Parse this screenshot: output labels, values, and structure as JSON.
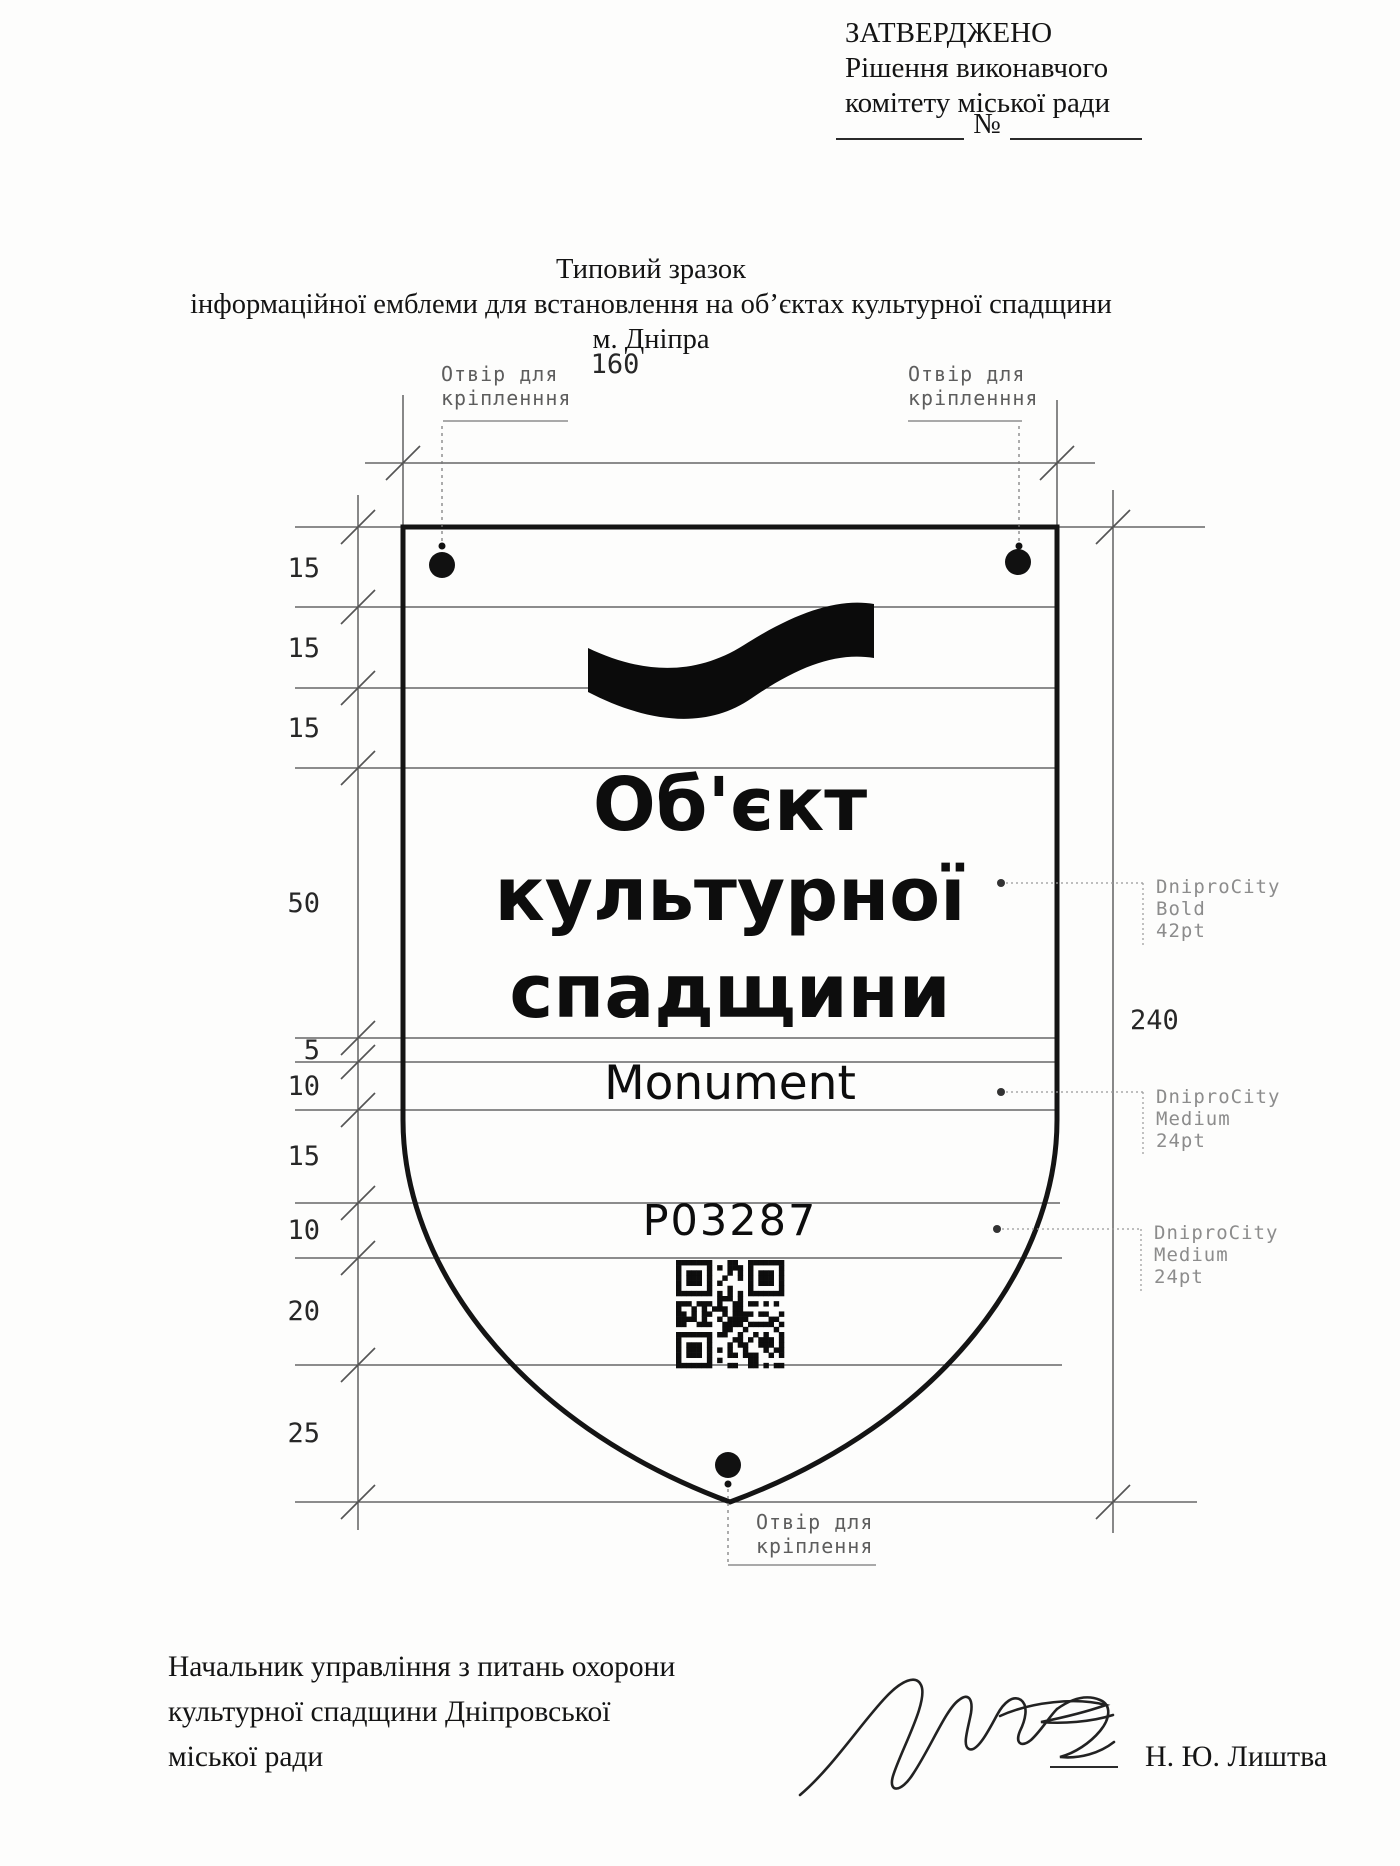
{
  "approval": {
    "line1": "ЗАТВЕРДЖЕНО",
    "line2": "Рішення виконавчого",
    "line3": "комітету міської ради",
    "number_sign": "№"
  },
  "title": {
    "line1": "Типовий зразок",
    "line2": "інформаційної емблеми для встановлення на об’єктах культурної спадщини",
    "line3": "м. Дніпра"
  },
  "drawing": {
    "dim_width": "160",
    "dim_height": "240",
    "left_dims": [
      "15",
      "15",
      "15",
      "50",
      "5",
      "10",
      "15",
      "10",
      "20",
      "25"
    ],
    "hole_label_top_left": {
      "line1": "Отвір для",
      "line2": "кріпленння"
    },
    "hole_label_top_right": {
      "line1": "Отвір для",
      "line2": "кріпленння"
    },
    "hole_label_bottom": {
      "line1": "Отвір для",
      "line2": "кріплення"
    },
    "font_note_title": {
      "line1": "DniproCity",
      "line2": "Bold",
      "line3": "42pt"
    },
    "font_note_subtitle": {
      "line1": "DniproCity",
      "line2": "Medium",
      "line3": "24pt"
    },
    "font_note_code": {
      "line1": "DniproCity",
      "line2": "Medium",
      "line3": "24pt"
    },
    "emblem": {
      "title_line1": "Об'єкт",
      "title_line2": "культурної",
      "title_line3": "спадщини",
      "subtitle": "Monument",
      "code": "P03287",
      "logo_icon": "dnipro-wave-icon",
      "qr_icon": "qr-code"
    }
  },
  "signature_block": {
    "line1": "Начальник управління з питань охорони",
    "line2": "культурної спадщини Дніпровської",
    "line3": "міської ради",
    "name": "Н. Ю. Лиштва"
  },
  "colors": {
    "ink": "#141414",
    "guide_line": "#4a4a4a",
    "muted_note": "#8c8c8c",
    "paper": "#fdfdfc"
  }
}
